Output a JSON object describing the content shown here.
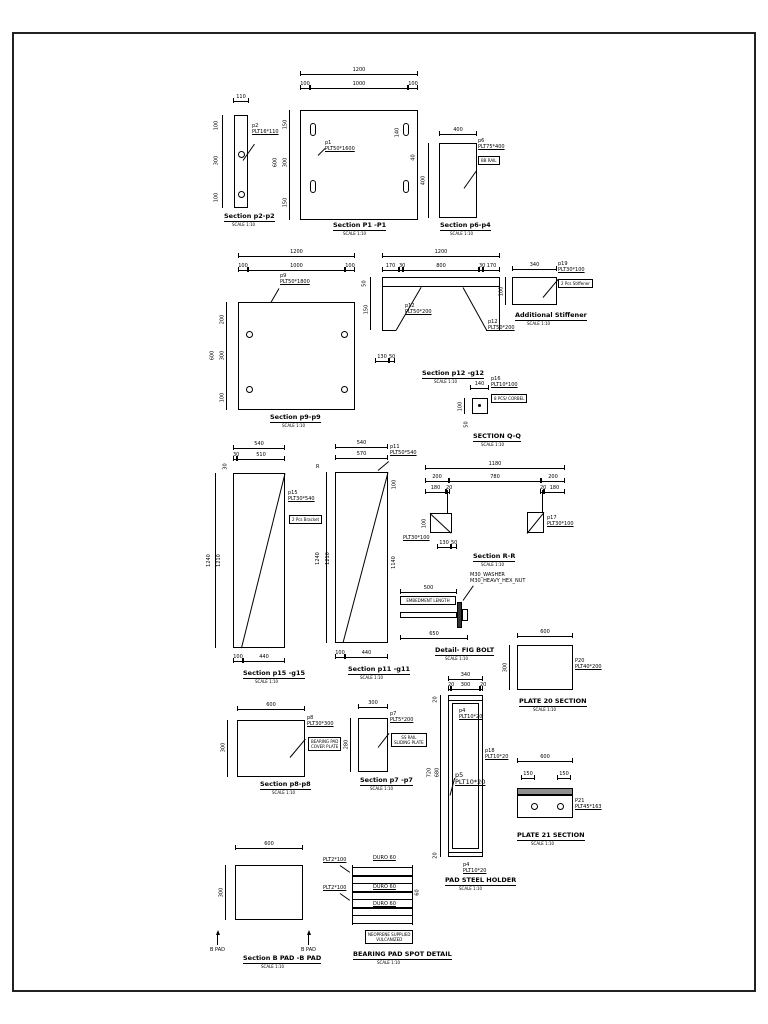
{
  "figures": {
    "p2": {
      "title": "Section p2-p2",
      "scale": "SCALE 1:10",
      "tag": "p2",
      "size": "PLT16*110",
      "w": "110",
      "left": [
        "100",
        "300",
        "100"
      ]
    },
    "p1": {
      "title": "Section P1 -P1",
      "scale": "SCALE 1:10",
      "tag": "p1",
      "size": "PLT50*1600",
      "w": "1200",
      "segs": [
        "100",
        "1000",
        "100"
      ],
      "left_total": "600",
      "left": [
        "150",
        "300",
        "150"
      ],
      "right": [
        "140",
        "40"
      ]
    },
    "p6": {
      "title": "Section p6-p4",
      "scale": "SCALE 1:10",
      "tag": "p6",
      "size": "PLT75*400",
      "w": "400",
      "h": "400",
      "box": "BB RAIL"
    },
    "p9": {
      "title": "Section p9-p9",
      "scale": "SCALE 1:10",
      "tag": "p9",
      "size": "PLT50*1800",
      "w": "1200",
      "segs": [
        "100",
        "1000",
        "100"
      ],
      "left_total": "600",
      "left": [
        "200",
        "300",
        "100"
      ]
    },
    "p12": {
      "title": "Section p12 -g12",
      "scale": "SCALE 1:10",
      "tag": "p12",
      "size": "PLT50*200",
      "w": "1200",
      "segs": [
        "170",
        "30",
        "800",
        "30",
        "170"
      ],
      "left": [
        "50",
        "150"
      ],
      "bottom": [
        "130",
        "50"
      ]
    },
    "stif": {
      "title": "Additional Stiffener",
      "scale": "SCALE 1:10",
      "tag": "p19",
      "size": "PLT30*100",
      "w": "340",
      "h": "100",
      "box": "2 Pcs Stiffener"
    },
    "qq": {
      "title": "SECTION Q-Q",
      "scale": "SCALE 1:10",
      "tag": "p16",
      "size": "PLT10*100",
      "w": "140",
      "left": "100",
      "bottom": "50",
      "box": "8 PCS/ CORBEL"
    },
    "p15": {
      "title": "Section p15 -g15",
      "scale": "SCALE 1:10",
      "tag": "p15",
      "size": "PLT30*540",
      "w": "540",
      "segs": [
        "30",
        "510"
      ],
      "topleft": "30",
      "left": [
        "1240",
        "1210"
      ],
      "bottom": [
        "100",
        "440"
      ],
      "box": "2 Pcs Bracket"
    },
    "p11": {
      "title": "Section p11 -g11",
      "scale": "SCALE 1:10",
      "tag": "p11",
      "size": "PLT50*540",
      "w": "540",
      "w2": "570",
      "mark": "R",
      "left": [
        "1240",
        "1210"
      ],
      "right": [
        "100",
        "1140"
      ],
      "bottom": [
        "100",
        "440"
      ]
    },
    "rr": {
      "title": "Section R-R",
      "scale": "SCALE 1:10",
      "tag": "p17",
      "size": "PLT30*100",
      "size_left": "PLT30*100",
      "w": "1180",
      "segs": [
        "200",
        "780",
        "200"
      ],
      "subs": [
        "180",
        "20",
        "20",
        "180"
      ],
      "left": "100",
      "bottom": [
        "130",
        "50"
      ]
    },
    "bolt": {
      "title": "Detail- FIG BOLT",
      "scale": "SCALE 1:10",
      "top": "500",
      "box": "EMBEDMENT LENGTH",
      "washer": "M30_WASHER",
      "nut": "M30_HEAVY_HEX_NUT",
      "bottom": "650"
    },
    "p20": {
      "title": "PLATE 20 SECTION",
      "scale": "SCALE 1:10",
      "tag": "P20",
      "size": "PLT40*200",
      "w": "600",
      "h": "300"
    },
    "p8": {
      "title": "Section p8-p8",
      "scale": "SCALE 1:10",
      "tag": "p8",
      "size": "PLT30*300",
      "w": "600",
      "h": "300",
      "box1": "BEARING PAD",
      "box2": "COVER PLATE"
    },
    "p7": {
      "title": "Section p7 -p7",
      "scale": "SCALE 1:10",
      "tag": "p7",
      "size": "PLT5*200",
      "w": "300",
      "h": "280",
      "box1": "SS RAIL",
      "box2": "SLIDING PLATE"
    },
    "hold": {
      "title": "PAD STEEL HOLDER",
      "scale": "SCALE 1:10",
      "w": "340",
      "segs": [
        "20",
        "300",
        "20"
      ],
      "left": [
        "20",
        "720",
        "680",
        "20"
      ],
      "tag_top": "p4",
      "size_top": "PLT10*20",
      "tag_side": "p18",
      "size_side": "PLT10*20",
      "tag_mid": "p5",
      "size_mid": "PLT10*20",
      "tag_bot": "p4",
      "size_bot": "PLT10*20"
    },
    "p21": {
      "title": "PLATE 21 SECTION",
      "scale": "SCALE 1:10",
      "tag": "P21",
      "size": "PLT45*163",
      "w": "600",
      "subs": [
        "150",
        "150"
      ]
    },
    "bpad": {
      "title": "Section B PAD -B PAD",
      "scale": "SCALE 1:10",
      "w": "600",
      "h": "300",
      "marker": "B PAD"
    },
    "spot": {
      "title": "BEARING PAD SPOT DETAIL",
      "scale": "SCALE 1:10",
      "plt": "PLT2*100",
      "elast": "DURO 60",
      "dim": "60",
      "box1": "NEOPRENE SUPPLIED",
      "box2": "VULCANIZED"
    }
  }
}
